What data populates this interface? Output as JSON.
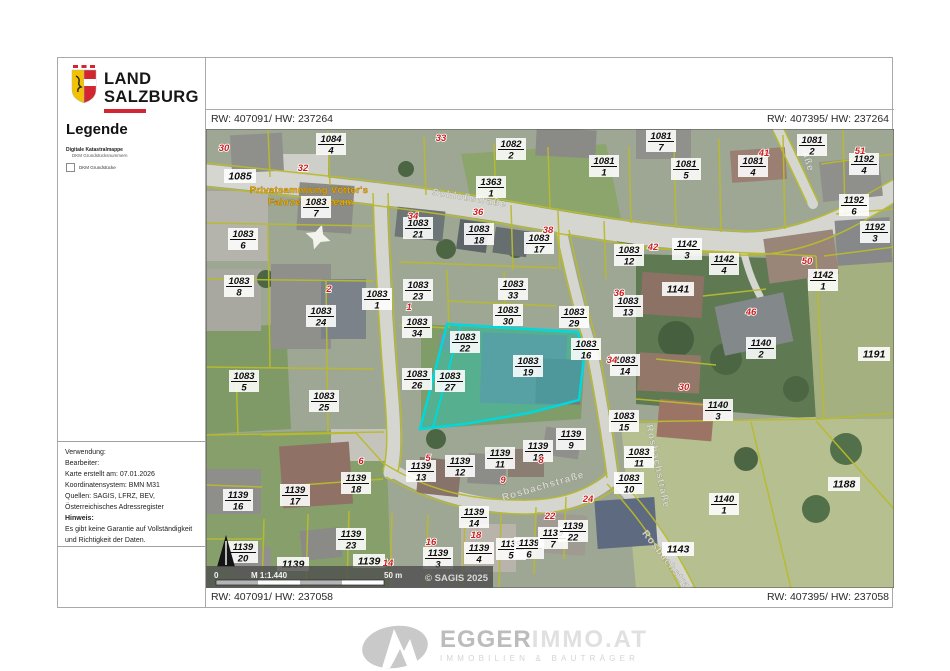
{
  "header": {
    "logo_line1": "LAND",
    "logo_line2": "SALZBURG"
  },
  "legend": {
    "title": "Legende",
    "group_label": "Digitale Katastralmappe",
    "group_sub": "DKM Grundstücksnummern",
    "checkbox_label": "DKM Grundstücke"
  },
  "info_box": {
    "lines": [
      "Verwendung:",
      "Bearbeiter:",
      "Karte erstellt am: 07.01.2026",
      "Koordinatensystem: BMN M31",
      "Quellen: SAGIS, LFRZ, BEV,",
      "Österreichisches Adressregister"
    ],
    "note_label": "Hinweis:",
    "note_lines": [
      "Es gibt keine Garantie auf Vollständigkeit",
      "und Richtigkeit der Daten."
    ]
  },
  "coordinates": {
    "top_left": "RW: 407091/ HW: 237264",
    "top_right": "RW: 407395/ HW: 237264",
    "bottom_left": "RW: 407091/ HW: 237058",
    "bottom_right": "RW: 407395/ HW: 237058"
  },
  "scalebar": {
    "zero": "0",
    "scale": "M 1:1.440",
    "distance": "50 m",
    "copyright": "© SAGIS 2025"
  },
  "footer_logo": {
    "name": "EGGER",
    "suffix": "IMMO.AT",
    "tagline": "IMMOBILIEN & BAUTRÄGER"
  },
  "map": {
    "colors": {
      "highlight": "#00d8dc",
      "parcel_line": "#b9bb2e",
      "house_number": "#cc1f1f",
      "poi": "#e6a400",
      "road": "#d6d6d0",
      "brand_red": "#d22630",
      "strip": "#4f4f4f"
    },
    "poi": {
      "line1": "Privatsammlung Vötter's",
      "line2": "Fahrzeugmuseum",
      "x": 103,
      "y": 64
    },
    "street_labels": [
      {
        "t": "Schloßstraße",
        "x": 263,
        "y": 72,
        "r": 9
      },
      {
        "t": "Rosbachstraße",
        "x": 338,
        "y": 360,
        "r": -16
      },
      {
        "t": "Rosbachstraße",
        "x": 449,
        "y": 338,
        "r": 78
      },
      {
        "t": "Rosbachstraße",
        "x": 462,
        "y": 438,
        "r": 52
      },
      {
        "t": "straße",
        "x": 597,
        "y": 26,
        "r": 73
      }
    ],
    "highlight": {
      "outline": "241,195 372,203 378,228 373,271 323,284 259,295 214,300",
      "divider": "254,198 227,298"
    },
    "parcels": [
      [
        125,
        15,
        "1084",
        "4"
      ],
      [
        34,
        47,
        "1085",
        ""
      ],
      [
        110,
        78,
        "1083",
        "7"
      ],
      [
        305,
        20,
        "1082",
        "2"
      ],
      [
        398,
        37,
        "1081",
        "1"
      ],
      [
        455,
        12,
        "1081",
        "7"
      ],
      [
        480,
        40,
        "1081",
        "5"
      ],
      [
        547,
        37,
        "1081",
        "4"
      ],
      [
        606,
        16,
        "1081",
        "2"
      ],
      [
        658,
        35,
        "1192",
        "4"
      ],
      [
        648,
        76,
        "1192",
        "6"
      ],
      [
        669,
        103,
        "1192",
        "3"
      ],
      [
        285,
        58,
        "1363",
        "1"
      ],
      [
        37,
        110,
        "1083",
        "6"
      ],
      [
        212,
        99,
        "1083",
        "21"
      ],
      [
        273,
        105,
        "1083",
        "18"
      ],
      [
        333,
        114,
        "1083",
        "17"
      ],
      [
        423,
        126,
        "1083",
        "12"
      ],
      [
        481,
        120,
        "1142",
        "3"
      ],
      [
        518,
        135,
        "1142",
        "4"
      ],
      [
        472,
        160,
        "1141",
        ""
      ],
      [
        617,
        151,
        "1142",
        "1"
      ],
      [
        33,
        157,
        "1083",
        "8"
      ],
      [
        115,
        187,
        "1083",
        "24"
      ],
      [
        171,
        170,
        "1083",
        "1"
      ],
      [
        212,
        161,
        "1083",
        "23"
      ],
      [
        307,
        160,
        "1083",
        "33"
      ],
      [
        302,
        186,
        "1083",
        "30"
      ],
      [
        368,
        188,
        "1083",
        "29"
      ],
      [
        211,
        198,
        "1083",
        "34"
      ],
      [
        422,
        177,
        "1083",
        "13"
      ],
      [
        259,
        213,
        "1083",
        "22"
      ],
      [
        322,
        237,
        "1083",
        "19"
      ],
      [
        380,
        220,
        "1083",
        "16"
      ],
      [
        419,
        236,
        "1083",
        "14"
      ],
      [
        38,
        252,
        "1083",
        "5"
      ],
      [
        118,
        272,
        "1083",
        "25"
      ],
      [
        211,
        250,
        "1083",
        "26"
      ],
      [
        244,
        252,
        "1083",
        "27"
      ],
      [
        418,
        292,
        "1083",
        "15"
      ],
      [
        555,
        219,
        "1140",
        "2"
      ],
      [
        668,
        225,
        "1191",
        ""
      ],
      [
        512,
        281,
        "1140",
        "3"
      ],
      [
        433,
        328,
        "1083",
        "11"
      ],
      [
        423,
        354,
        "1083",
        "10"
      ],
      [
        518,
        375,
        "1140",
        "1"
      ],
      [
        638,
        355,
        "1188",
        ""
      ],
      [
        472,
        420,
        "1143",
        ""
      ],
      [
        89,
        366,
        "1139",
        "17"
      ],
      [
        32,
        371,
        "1139",
        "16"
      ],
      [
        150,
        354,
        "1139",
        "18"
      ],
      [
        215,
        342,
        "1139",
        "13"
      ],
      [
        254,
        337,
        "1139",
        "12"
      ],
      [
        294,
        329,
        "1139",
        "11"
      ],
      [
        332,
        322,
        "1139",
        "10"
      ],
      [
        365,
        310,
        "1139",
        "9"
      ],
      [
        268,
        388,
        "1139",
        "14"
      ],
      [
        145,
        410,
        "1139",
        "23"
      ],
      [
        87,
        435,
        "1139",
        ""
      ],
      [
        163,
        432,
        "1139",
        ""
      ],
      [
        232,
        429,
        "1139",
        "3"
      ],
      [
        273,
        424,
        "1139",
        "4"
      ],
      [
        305,
        420,
        "1139",
        "5"
      ],
      [
        323,
        419,
        "1139",
        "6"
      ],
      [
        347,
        409,
        "1139",
        "7"
      ],
      [
        367,
        402,
        "1139",
        "22"
      ],
      [
        37,
        423,
        "1139",
        "20"
      ]
    ],
    "houses": [
      [
        18,
        22,
        "30"
      ],
      [
        97,
        42,
        "32"
      ],
      [
        235,
        12,
        "33"
      ],
      [
        207,
        90,
        "34"
      ],
      [
        272,
        86,
        "36"
      ],
      [
        342,
        104,
        "38"
      ],
      [
        558,
        27,
        "41"
      ],
      [
        654,
        25,
        "51"
      ],
      [
        447,
        121,
        "42"
      ],
      [
        601,
        135,
        "50"
      ],
      [
        413,
        167,
        "36"
      ],
      [
        545,
        186,
        "46"
      ],
      [
        406,
        234,
        "34"
      ],
      [
        478,
        261,
        "30"
      ],
      [
        203,
        181,
        "1"
      ],
      [
        123,
        163,
        "2"
      ],
      [
        155,
        335,
        "6"
      ],
      [
        222,
        332,
        "5"
      ],
      [
        297,
        354,
        "9"
      ],
      [
        335,
        334,
        "8"
      ],
      [
        382,
        373,
        "24"
      ],
      [
        344,
        390,
        "22"
      ],
      [
        270,
        409,
        "18"
      ],
      [
        225,
        416,
        "16"
      ],
      [
        182,
        437,
        "14"
      ]
    ]
  }
}
